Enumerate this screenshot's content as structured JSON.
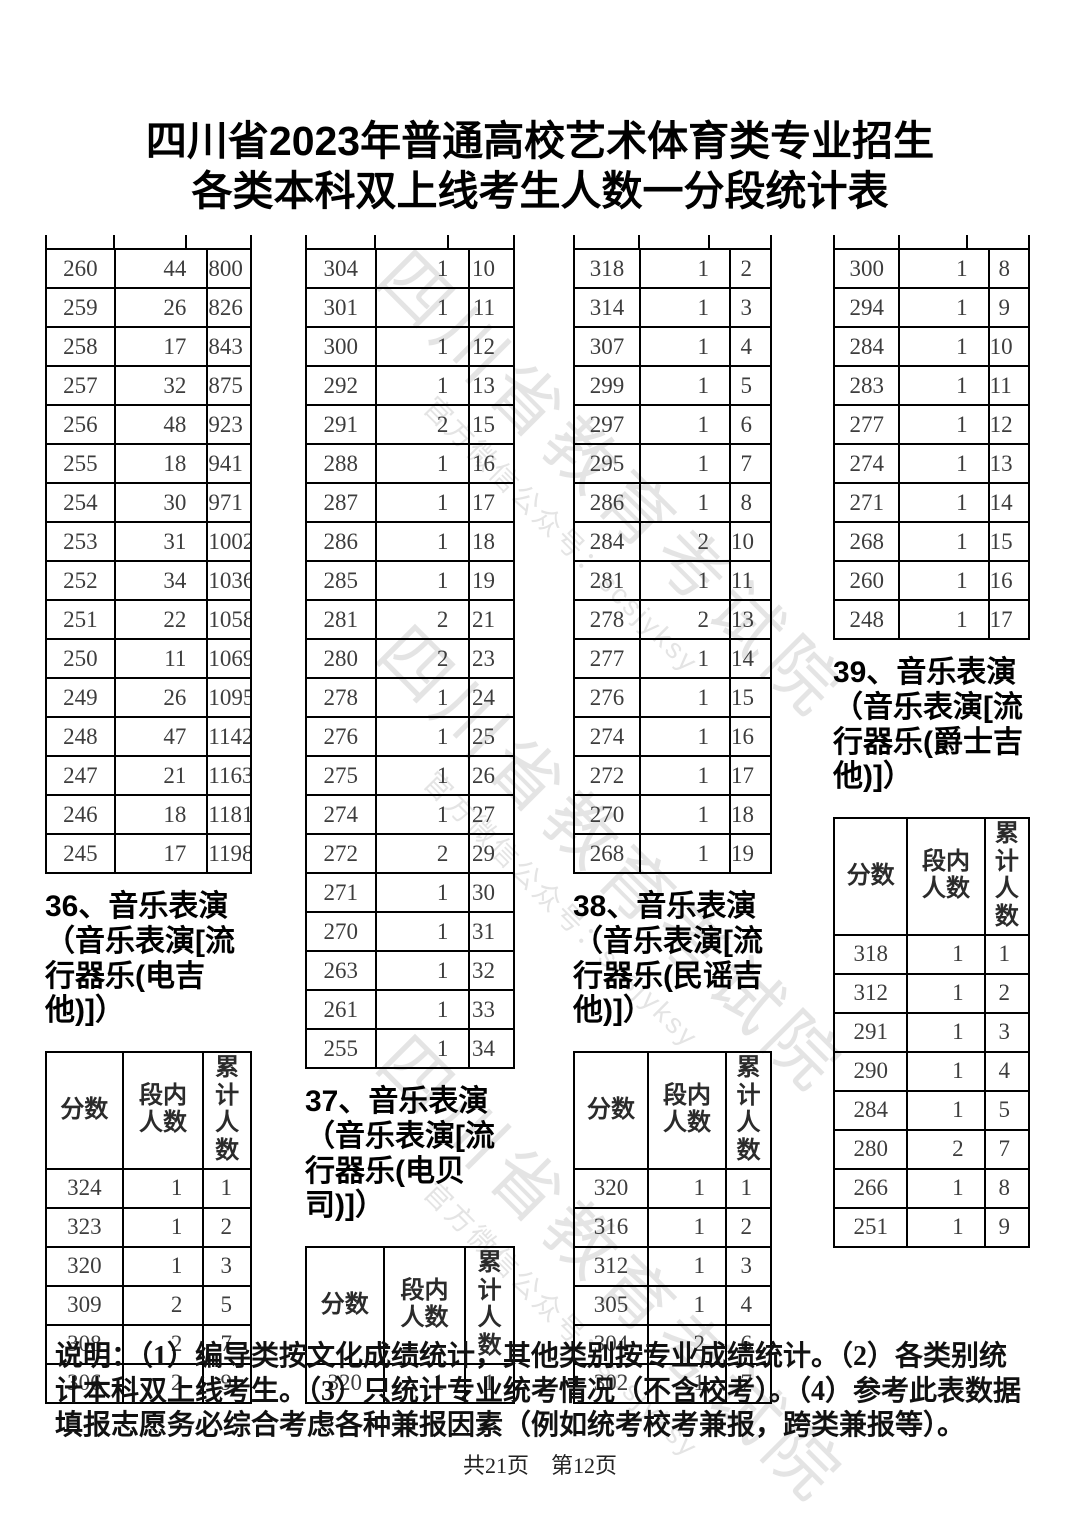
{
  "title": {
    "line1": "四川省2023年普通高校艺术体育类专业招生",
    "line2": "各类本科双上线考生人数一分段统计表"
  },
  "watermark": {
    "line1": "四川省教育考试院",
    "line2": "官方微信公众号：scsjyksy"
  },
  "table_header": {
    "score": "分数",
    "in_band": "段内人数",
    "cumulative": "累计人数"
  },
  "columns": [
    {
      "continuation_rows": [
        [
          260,
          44,
          800
        ],
        [
          259,
          26,
          826
        ],
        [
          258,
          17,
          843
        ],
        [
          257,
          32,
          875
        ],
        [
          256,
          48,
          923
        ],
        [
          255,
          18,
          941
        ],
        [
          254,
          30,
          971
        ],
        [
          253,
          31,
          1002
        ],
        [
          252,
          34,
          1036
        ],
        [
          251,
          22,
          1058
        ],
        [
          250,
          11,
          1069
        ],
        [
          249,
          26,
          1095
        ],
        [
          248,
          47,
          1142
        ],
        [
          247,
          21,
          1163
        ],
        [
          246,
          18,
          1181
        ],
        [
          245,
          17,
          1198
        ]
      ],
      "section_title": "36、音乐表演（音乐表演[流行器乐(电吉他)]）",
      "table_rows": [
        [
          324,
          1,
          1
        ],
        [
          323,
          1,
          2
        ],
        [
          320,
          1,
          3
        ],
        [
          309,
          2,
          5
        ],
        [
          308,
          2,
          7
        ],
        [
          306,
          2,
          9
        ]
      ]
    },
    {
      "continuation_rows": [
        [
          304,
          1,
          10
        ],
        [
          301,
          1,
          11
        ],
        [
          300,
          1,
          12
        ],
        [
          292,
          1,
          13
        ],
        [
          291,
          2,
          15
        ],
        [
          288,
          1,
          16
        ],
        [
          287,
          1,
          17
        ],
        [
          286,
          1,
          18
        ],
        [
          285,
          1,
          19
        ],
        [
          281,
          2,
          21
        ],
        [
          280,
          2,
          23
        ],
        [
          278,
          1,
          24
        ],
        [
          276,
          1,
          25
        ],
        [
          275,
          1,
          26
        ],
        [
          274,
          1,
          27
        ],
        [
          272,
          2,
          29
        ],
        [
          271,
          1,
          30
        ],
        [
          270,
          1,
          31
        ],
        [
          263,
          1,
          32
        ],
        [
          261,
          1,
          33
        ],
        [
          255,
          1,
          34
        ]
      ],
      "section_title": "37、音乐表演（音乐表演[流行器乐(电贝司)]）",
      "table_rows": [
        [
          320,
          1,
          1
        ]
      ]
    },
    {
      "continuation_rows": [
        [
          318,
          1,
          2
        ],
        [
          314,
          1,
          3
        ],
        [
          307,
          1,
          4
        ],
        [
          299,
          1,
          5
        ],
        [
          297,
          1,
          6
        ],
        [
          295,
          1,
          7
        ],
        [
          286,
          1,
          8
        ],
        [
          284,
          2,
          10
        ],
        [
          281,
          1,
          11
        ],
        [
          278,
          2,
          13
        ],
        [
          277,
          1,
          14
        ],
        [
          276,
          1,
          15
        ],
        [
          274,
          1,
          16
        ],
        [
          272,
          1,
          17
        ],
        [
          270,
          1,
          18
        ],
        [
          268,
          1,
          19
        ]
      ],
      "section_title": "38、音乐表演（音乐表演[流行器乐(民谣吉他)]）",
      "table_rows": [
        [
          320,
          1,
          1
        ],
        [
          316,
          1,
          2
        ],
        [
          312,
          1,
          3
        ],
        [
          305,
          1,
          4
        ],
        [
          304,
          2,
          6
        ],
        [
          302,
          1,
          7
        ]
      ]
    },
    {
      "continuation_rows": [
        [
          300,
          1,
          8
        ],
        [
          294,
          1,
          9
        ],
        [
          284,
          1,
          10
        ],
        [
          283,
          1,
          11
        ],
        [
          277,
          1,
          12
        ],
        [
          274,
          1,
          13
        ],
        [
          271,
          1,
          14
        ],
        [
          268,
          1,
          15
        ],
        [
          260,
          1,
          16
        ],
        [
          248,
          1,
          17
        ]
      ],
      "section_title": "39、音乐表演（音乐表演[流行器乐(爵士吉他)]）",
      "table_rows": [
        [
          318,
          1,
          1
        ],
        [
          312,
          1,
          2
        ],
        [
          291,
          1,
          3
        ],
        [
          290,
          1,
          4
        ],
        [
          284,
          1,
          5
        ],
        [
          280,
          2,
          7
        ],
        [
          266,
          1,
          8
        ],
        [
          251,
          1,
          9
        ]
      ]
    }
  ],
  "footnote": "说明：（1）编导类按文化成绩统计，其他类别按专业成绩统计。（2）各类别统计本科双上线考生。（3）只统计专业统考情况（不含校考）。（4）参考此表数据填报志愿务必综合考虑各种兼报因素（例如统考校考兼报，跨类兼报等）。",
  "pagination": "共21页　第12页"
}
